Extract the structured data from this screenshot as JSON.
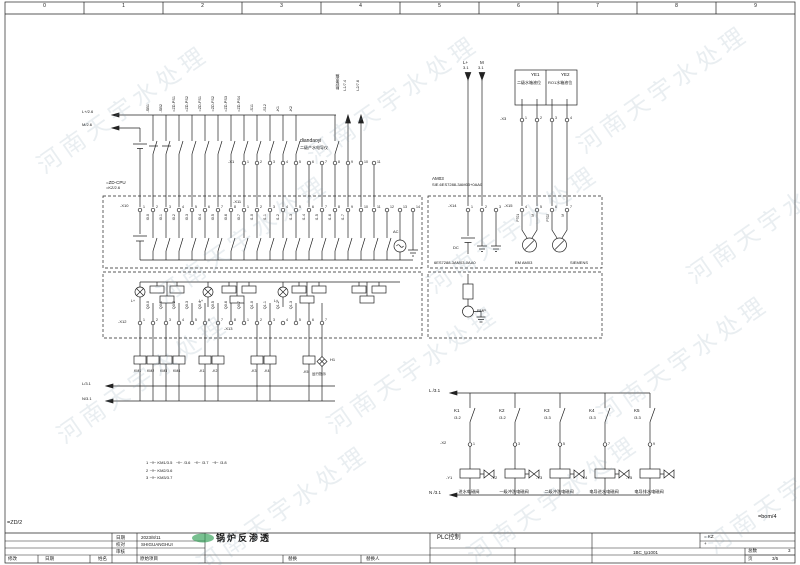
{
  "frame": {
    "columns": [
      "0",
      "1",
      "2",
      "3",
      "4",
      "5",
      "6",
      "7",
      "8",
      "9"
    ],
    "ref_left": "=ZD/2",
    "ref_right": "=bom/4"
  },
  "watermark": {
    "text": "河南天宇水处理"
  },
  "cpu": {
    "tag": "=ZD-CPU",
    "ref": "=KZ/2.6"
  },
  "buses": {
    "top1": "L+/2.6",
    "top2": "M/2.6",
    "bottom1": "L/3.1",
    "bottom2": "N/3.1"
  },
  "field": {
    "labels": [
      "-SB1",
      "-SB2",
      "=ZD-PS1",
      "=ZD-PS2",
      "=ZD-FS1",
      "=ZD-FS2",
      "=ZD-PS3",
      "=ZD-PS4",
      "-S11",
      "-S12",
      "-K1",
      "-K2"
    ],
    "tank_label": "脱盐水箱",
    "l1": "L1/7.4",
    "l2": "L2/7.6",
    "conductivity_en": "diandaoyi",
    "conductivity_cn": "二级产水电导仪",
    "x1_label": "-X1",
    "x1_terminals": [
      "1",
      "2",
      "3",
      "4",
      "5",
      "6",
      "7",
      "8",
      "9",
      "10",
      "11"
    ]
  },
  "di_module": {
    "x10_label": "-X10",
    "x10_terminals": [
      "1",
      "2",
      "3",
      "4",
      "5",
      "6",
      "7",
      "8"
    ],
    "x11_label": "-X11",
    "x11_terminals": [
      "1",
      "2",
      "3",
      "4",
      "5",
      "6",
      "7",
      "8",
      "9",
      "10",
      "11",
      "12",
      "13",
      "14"
    ],
    "channels": [
      "I0.0",
      "I0.1",
      "I0.2",
      "I0.3",
      "I0.4",
      "I0.5",
      "I0.6",
      "I0.7",
      "I1.0",
      "I1.1",
      "I1.2",
      "I1.3",
      "I1.4",
      "I1.5",
      "I1.6",
      "I1.7"
    ],
    "ac_label": "AC"
  },
  "ai_module": {
    "name": "AM03",
    "code": "SIE.6ES7288-3AM03+0AA0",
    "x14_label": "-X14",
    "x14_terminals": [
      "1",
      "2",
      "3"
    ],
    "x15_label": "-X15",
    "x15_terminals": [
      "4",
      "5",
      "6",
      "7"
    ],
    "dc_label": "DC",
    "signal_labels": [
      "PT01",
      "M",
      "PT02",
      "M"
    ],
    "bottom_code": "6ES7288-3AM03-0AA0",
    "bottom_name": "EM AM03",
    "brand": "SIEMENS"
  },
  "do_module": {
    "x12_label": "-X12",
    "x12_terminals": [
      "1",
      "2",
      "3",
      "4",
      "5",
      "6",
      "7",
      "8"
    ],
    "x13_label": "-X13",
    "x13_terminals": [
      "1",
      "2",
      "3",
      "4",
      "5",
      "6",
      "7"
    ],
    "channels": [
      "Q0.0",
      "Q0.1",
      "Q0.2",
      "Q0.3",
      "Q0.4",
      "Q0.5",
      "Q0.6",
      "Q0.7",
      "Q1.0",
      "Q1.1",
      "Q1.2",
      "Q1.3"
    ],
    "lamp_labels": [
      "L+",
      "L+",
      "L+"
    ]
  },
  "relays": {
    "km": [
      "KM1",
      "KM2",
      "KM3",
      "KM4"
    ],
    "k12": [
      "-K1",
      "-K2"
    ],
    "k34": [
      "-K3",
      "-K4"
    ],
    "k5": "-K5",
    "h1": "H1",
    "h1_caption": "运行指示"
  },
  "aux_box": {
    "label": "RMP"
  },
  "level_box": {
    "l_plus": "L+",
    "l_ref": "3.1",
    "m": "M",
    "m_ref": "3.1",
    "ye1": "YE1",
    "ye1_cn": "二级水箱液位",
    "ye2": "YE2",
    "ye2_cn": "RO1水箱液位",
    "x3_label": "-X3",
    "x3_terminals": [
      "1",
      "2",
      "3",
      "4"
    ]
  },
  "ladder": {
    "rail_top": "L /3.1",
    "rail_bottom": "N /3.1",
    "x2_label": "-X2",
    "branches": [
      {
        "tag": "K1",
        "ref": "/3.2",
        "terminal": "1",
        "coil": "-Y1",
        "caption": "进水电磁阀"
      },
      {
        "tag": "K2",
        "ref": "/3.2",
        "terminal": "3",
        "coil": "-Y2",
        "caption": "一级冲洗电磁阀"
      },
      {
        "tag": "K3",
        "ref": "/3.3",
        "terminal": "5",
        "coil": "-Y3",
        "caption": "二级冲洗电磁阀"
      },
      {
        "tag": "K4",
        "ref": "/3.3",
        "terminal": "7",
        "coil": "-Y4",
        "caption": "电导进水电磁阀"
      },
      {
        "tag": "K5",
        "ref": "/3.3",
        "terminal": "9",
        "coil": "-Y5",
        "caption": "电导排水电磁阀"
      }
    ]
  },
  "crossrefs": [
    "1 ⊣⊢ KM1/3.5   ⊣⊢ /3.6   ⊣⊢ /3.7   ⊣⊢ /3.8",
    "2 ⊣⊢ KM2/3.6",
    "3 ⊣⊢ KM3/3.7"
  ],
  "title_block": {
    "date_label": "日期",
    "date_value": "2023/8/11",
    "check_label": "校对",
    "check_value": "SHIGUANGHUI",
    "audit_label": "审核",
    "modify_label": "修改",
    "mdate_label": "日期",
    "name_label": "姓名",
    "orig_label": "原始项目",
    "replace_label": "替换",
    "replaceby_label": "替换人",
    "title": "锅炉反渗透",
    "subtitle": "PLC控制",
    "kz": "= KZ",
    "plus": "+",
    "doc_no": "1BC_tp1001",
    "total_label": "总数",
    "total_value": "3",
    "page_label": "页",
    "page_value": "3/5"
  }
}
